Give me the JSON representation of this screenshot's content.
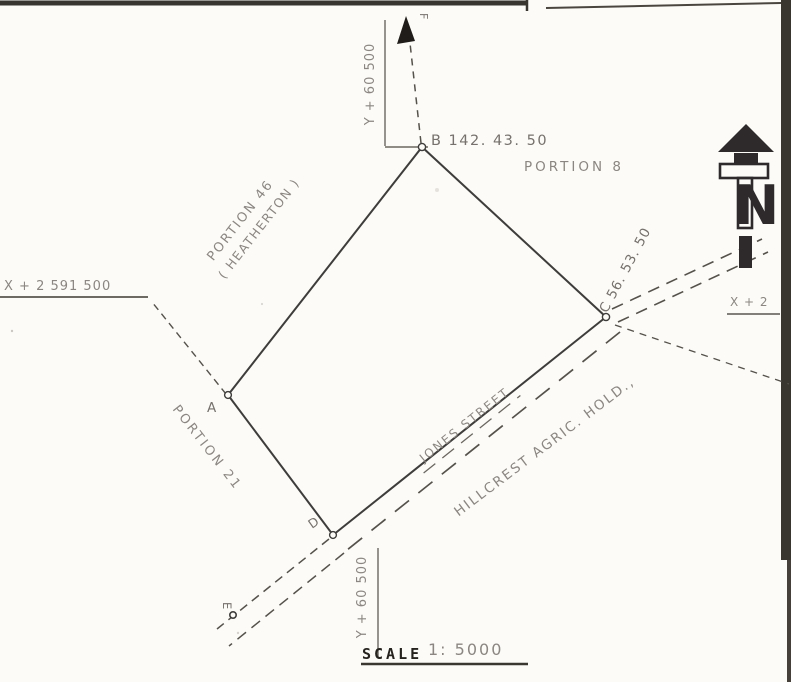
{
  "drawing": {
    "scale": {
      "label": "SCALE",
      "value": "1: 5000"
    },
    "grid": {
      "x_left": "X + 2 591 500",
      "x_right": "X + 2",
      "y_top": "Y + 60 500",
      "y_bottom": "Y + 60 500"
    },
    "points": {
      "a": "A",
      "b_bearing": "B 142. 43. 50",
      "c_bearing": "C 56. 53. 50",
      "d": "D",
      "e": "E",
      "f": "F"
    },
    "parcels": {
      "portion8": "PORTION 8",
      "portion46": "PORTION 46",
      "portion46_sub": "( HEATHERTON )",
      "portion21": "PORTION 21",
      "hillcrest": "HILLCREST  AGRIC.  HOLD.,"
    },
    "street_name": "JONES  STREET",
    "north": {
      "letter": "N"
    },
    "colors": {
      "boundary_ink": "#3f3d3b",
      "handwriting": "#8b8681",
      "north_symbol": "#2e2a2c"
    }
  }
}
